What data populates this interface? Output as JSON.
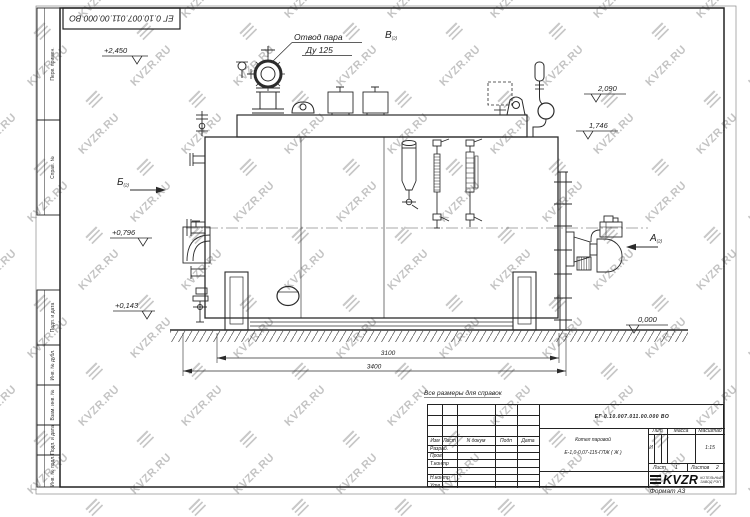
{
  "watermark": {
    "text": "KVZR.RU"
  },
  "stamp": {
    "doc_number": "ЕГ 0.10.007.011.00.000  ВО"
  },
  "frame": {
    "col_perv": "Перв. примен.",
    "col_sprav": "Справ. №",
    "col_podp1": "Подп. и дата",
    "col_inv_dubl": "Инв. № дубл.",
    "col_vzam": "Взам. инв. №",
    "col_podp2": "Подп. и дата",
    "col_inv_podl": "Инв. № подл.",
    "format": "Формат А3"
  },
  "ann": {
    "steam1": "Отвод пара",
    "steam2": "Ду 125",
    "view_v": "В",
    "view_v_sub": "(2)",
    "view_b": "Б",
    "view_b_sub": "(2)",
    "view_a": "А",
    "view_a_sub": "(2)",
    "elev_top": "+2,450",
    "elev_2090": "2,090",
    "elev_1746": "1,746",
    "elev_0796": "+0,796",
    "elev_0143": "+0,143",
    "elev_zero": "0,000",
    "dim_inner": "3100",
    "dim_outer": "3400",
    "note": "Все размеры для справок"
  },
  "tb": {
    "doc_number": "ЕГ 0.10.007.011.00.000  ВО",
    "product1": "Котел паровой",
    "product2": "Е-1,0-0,07-115-ГЛЖ ( Ж )",
    "h_izm": "Изм",
    "h_list": "Лист",
    "h_ndoc": "N докум",
    "h_podp": "Подп",
    "h_data": "Дата",
    "r1": "Разраб.",
    "r2": "Пров.",
    "r3": "Т.контр",
    "r4": "Н.контр",
    "r5": "Утв.",
    "lit_label": "Лит",
    "massa_label": "Масса",
    "scale_label": "Масштаб",
    "lit_value": "И",
    "scale_value": "1:15",
    "sheet_label": "Лист",
    "sheet_value": "1",
    "sheets_label": "Листов",
    "sheets_value": "2",
    "logo_word": "KVZR",
    "logo_sub1": "КОТЕЛЬНЫЙ",
    "logo_sub2": "ЗАВОД РЭП"
  }
}
